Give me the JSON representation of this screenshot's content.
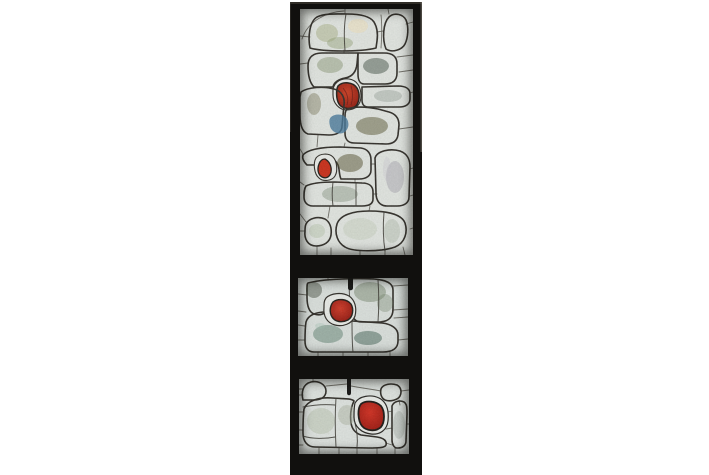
{
  "meta": {
    "type": "photograph",
    "description": "Abstract stained-glass window set in a black frame: one tall upper light and two small lower lights, made of organic pieces of green, olive, grey and cream glass accented by red ovals."
  },
  "window": {
    "page_background": "#ffffff",
    "frame_color": "#11100e",
    "frame_top_highlight": "#4a453d",
    "frame_right_highlight": "#6b675f",
    "frame_left_highlight": "#3c3933",
    "lead_color": "#2b2822",
    "halo_color": "#eef1ec",
    "tab_color": "#0d0d0b",
    "panels": {
      "top": {
        "label": "upper light",
        "glass_background": "#e6eae5"
      },
      "middle": {
        "label": "middle light",
        "glass_background": "#dfe5e1"
      },
      "bottom": {
        "label": "lower light",
        "glass_background": "#e3e8e4"
      }
    }
  },
  "glass_colors": {
    "cream_dome": "#e7dbae",
    "white_blob": "#eff1ee",
    "moss_slab": "#75826c",
    "dark_slab": "#454e47",
    "sparkle_slab": "#8c958e",
    "olive_lobe": "#37351d",
    "olive_band": "#3c3a20",
    "olive_mass": "#343118",
    "blue_flash": "#41759a",
    "grey_green_band": "#7b8879",
    "lavender_column": "#8f8c96",
    "sage_small": "#a8b9a0",
    "sage_large": "#b7c3b3",
    "red_bright": "#cf3a1d",
    "red_deep": "#8c1206",
    "red_small": "#cd2912",
    "mid_dark_green": "#35452e",
    "mid_teal": "#32554a",
    "mid_red_bright": "#d23521",
    "mid_red_deep": "#8e1008",
    "bottom_olive": "#55512f",
    "bottom_teal": "#2a4540",
    "bottom_mass": "#9aa793",
    "bottom_red_bright": "#d52b1c",
    "bottom_red_deep": "#9a1209",
    "bottom_column": "#8e9b90"
  }
}
